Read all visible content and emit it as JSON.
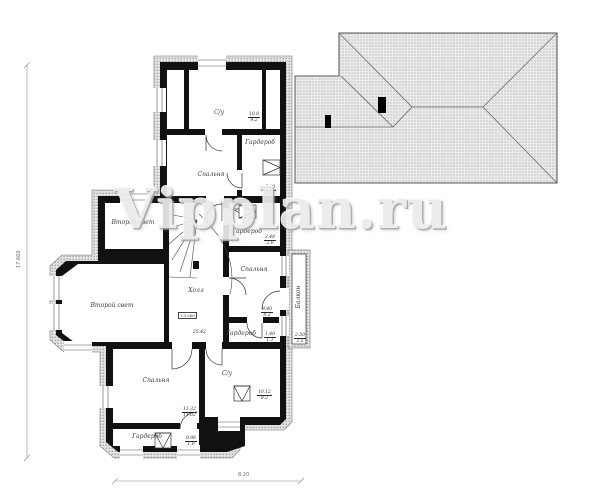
{
  "watermark": {
    "text": "Vipplan.ru"
  },
  "rooms": [
    {
      "key": "su-top",
      "label": "С/у"
    },
    {
      "key": "garderob-top",
      "label": "Гардероб"
    },
    {
      "key": "spalnya-top",
      "label": "Спальня"
    },
    {
      "key": "vtoroy-svet-small",
      "label": "Второй свет"
    },
    {
      "key": "garderob-mid",
      "label": "Гардероб"
    },
    {
      "key": "spalnya-mid",
      "label": "Спальня"
    },
    {
      "key": "kholl",
      "label": "Холл"
    },
    {
      "key": "vtoroy-svet-big",
      "label": "Второй свет"
    },
    {
      "key": "garderob-mid2",
      "label": "Гардероб"
    },
    {
      "key": "balkon",
      "label": "Балкон"
    },
    {
      "key": "spalnya-bottom",
      "label": "Спальня"
    },
    {
      "key": "garderob-bottom",
      "label": "Гардероб"
    },
    {
      "key": "su-bottom",
      "label": "С/у"
    }
  ],
  "stamps": [
    {
      "key": "su-top",
      "top": "10.8",
      "bottom": "9.2"
    },
    {
      "key": "garderob-top",
      "top": "6.10",
      "bottom": "6.2"
    },
    {
      "key": "garderob-mid",
      "top": "2.48",
      "bottom": "2.0"
    },
    {
      "key": "spalnya-mid",
      "top": "8.40",
      "bottom": "8.2"
    },
    {
      "key": "garderob-mid2",
      "top": "1.40",
      "bottom": "1.1"
    },
    {
      "key": "balkon",
      "top": "2.50",
      "bottom": "2.5"
    },
    {
      "key": "spalnya-bottom",
      "top": "11.32",
      "bottom": "11.02"
    },
    {
      "key": "garderob-bottom",
      "top": "0.96",
      "bottom": "1.0"
    },
    {
      "key": "su-bottom",
      "top": "10.12",
      "bottom": "8.2"
    }
  ],
  "hall_note": "25.42",
  "elevation_marker": "+3.300",
  "dimensions": {
    "left": "17.660",
    "bottom": "8.20"
  },
  "colors": {
    "wall": "#111111",
    "roof_hatch": "#8f8f8f",
    "band_hatch": "#7a7a7a",
    "line": "#555555"
  }
}
